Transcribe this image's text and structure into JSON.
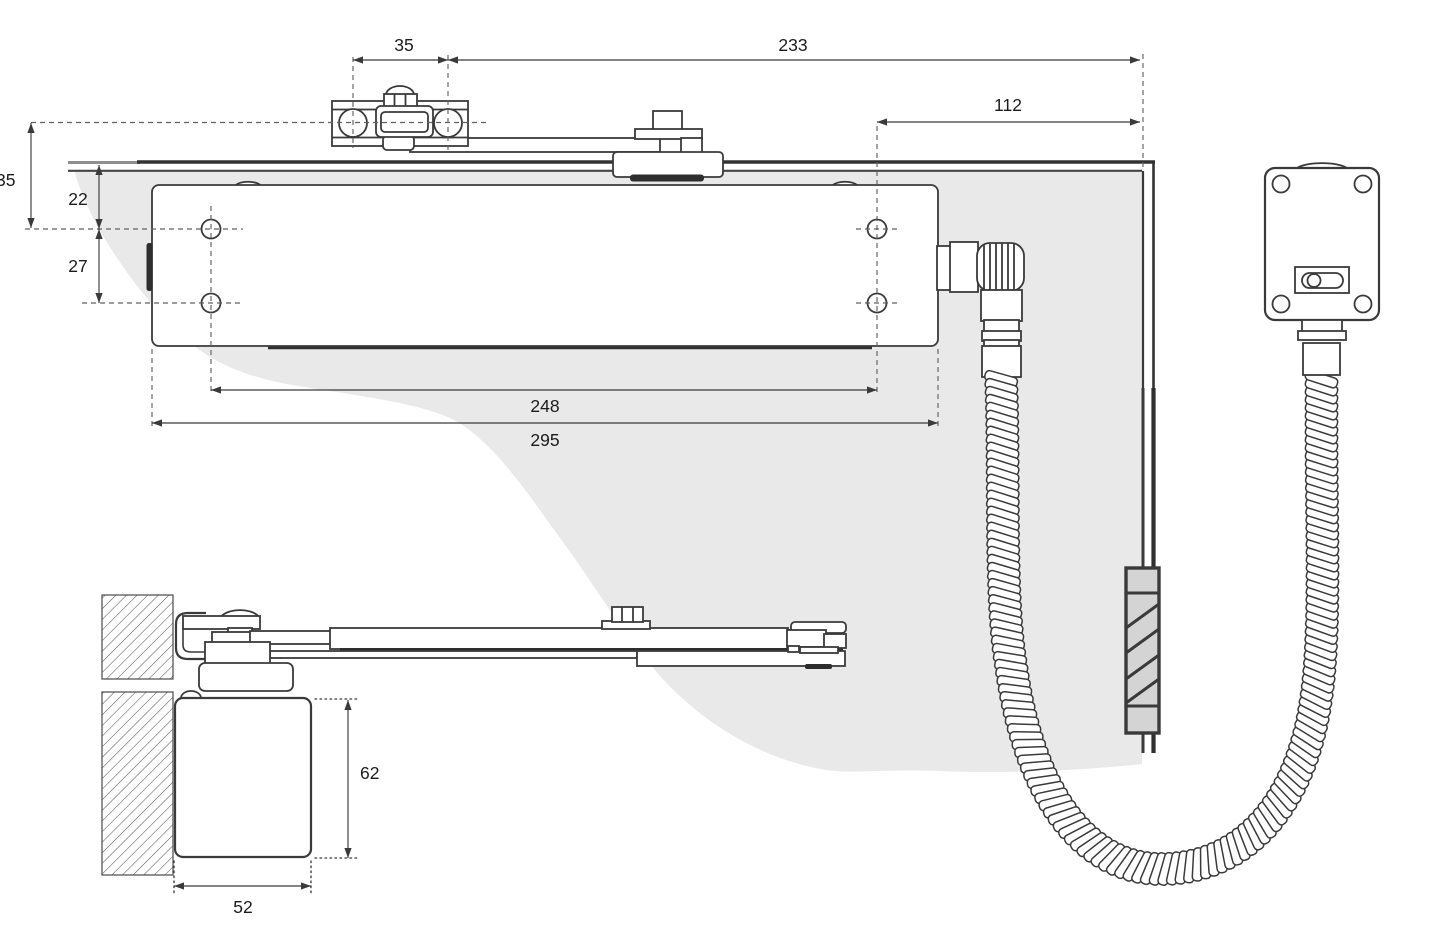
{
  "drawing": {
    "kind": "door-closer installation dimension diagram",
    "units": "mm",
    "colors": {
      "line": "#3a3a3a",
      "swing_shade": "#e9e9e9",
      "sleeve_fill": "#d4d4d4",
      "background": "#ffffff"
    },
    "dimensions": {
      "plan": {
        "bracket_screw_spacing": "35",
        "bracket_to_corner": "233",
        "cord_exit_to_corner": "112",
        "axis_to_hole_row": "35",
        "door_edge_to_hole_row": "22",
        "hole_row_spacing": "27",
        "hole_span": "248",
        "body_length": "295"
      },
      "side": {
        "body_height": "62",
        "body_depth": "52"
      }
    }
  }
}
